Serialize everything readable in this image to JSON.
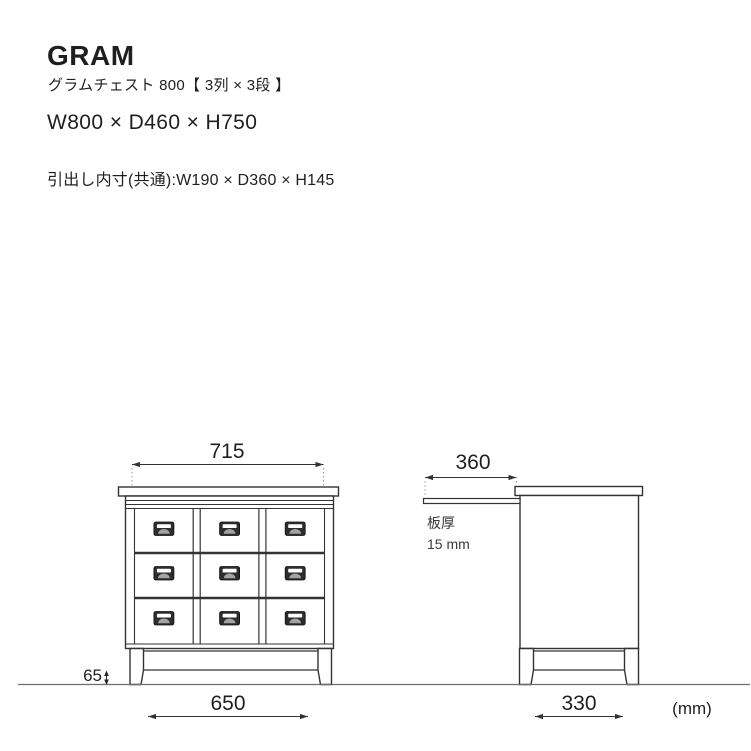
{
  "header": {
    "brand": "GRAM",
    "subtitle": "グラムチェスト 800【 3列 × 3段 】",
    "overall_size": "W800 × D460 × H750",
    "drawer_inner_size": "引出し内寸(共通):W190 × D360 × H145"
  },
  "front_view": {
    "top_inner_width_mm": "715",
    "base_width_mm": "650",
    "leg_clearance_mm": "65",
    "drawer_grid": {
      "columns": 3,
      "rows": 3
    }
  },
  "side_view": {
    "drawer_extension_mm": "360",
    "base_depth_mm": "330",
    "board_thickness_label": "板厚",
    "board_thickness_value": "15 mm"
  },
  "footer": {
    "unit": "(mm)"
  },
  "colors": {
    "line": "#333333",
    "ground_line": "#6e6e6e",
    "dotted_extension": "#999999",
    "handle_frame": "#2d2d2d",
    "handle_slot": "#ffffff",
    "handle_dome": "#a3a3a3"
  }
}
